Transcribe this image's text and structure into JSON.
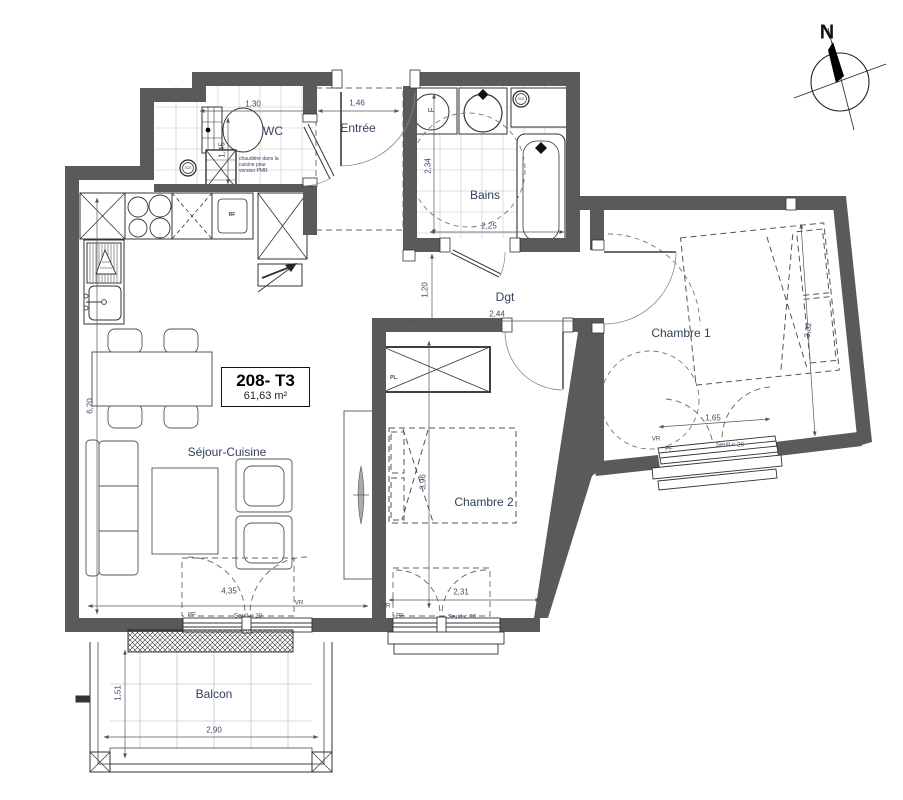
{
  "plan": {
    "north": "N",
    "unit": {
      "id": "208- T3",
      "area": "61,63 m²"
    },
    "rooms": {
      "wc": "WC",
      "entree": "Entrée",
      "bains": "Bains",
      "dgt": "Dgt",
      "chambre1": "Chambre 1",
      "chambre2": "Chambre 2",
      "sejour": "Séjour-Cuisine",
      "balcon": "Balcon"
    },
    "dims": {
      "wc_w": "1,30",
      "wc_d": "1,45",
      "entree_w": "1,46",
      "bains_d": "2,34",
      "bains_w": "2,25",
      "dgt_d": "1,20",
      "dgt_w": "2,44",
      "ch1_d": "3,32",
      "ch1_win": "1,65",
      "ch2_d": "3,96",
      "ch2_w": "2,31",
      "sejour_d": "6,20",
      "sejour_w": "4,35",
      "balcon_w": "2,90",
      "balcon_d": "1,51"
    },
    "tags": {
      "vr": "VR",
      "pf": "PF",
      "seuil": "Seuil < 20",
      "ll": "LL",
      "rf": "RF",
      "pl": "PL.",
      "sce": "SCE"
    },
    "note": {
      "l1": "chaudière dans la",
      "l2": "cuisine pour",
      "l3": "version PMR"
    },
    "colors": {
      "wall": "#5a5a5a",
      "label": "#33415e",
      "dim": "#3c4c66"
    }
  }
}
